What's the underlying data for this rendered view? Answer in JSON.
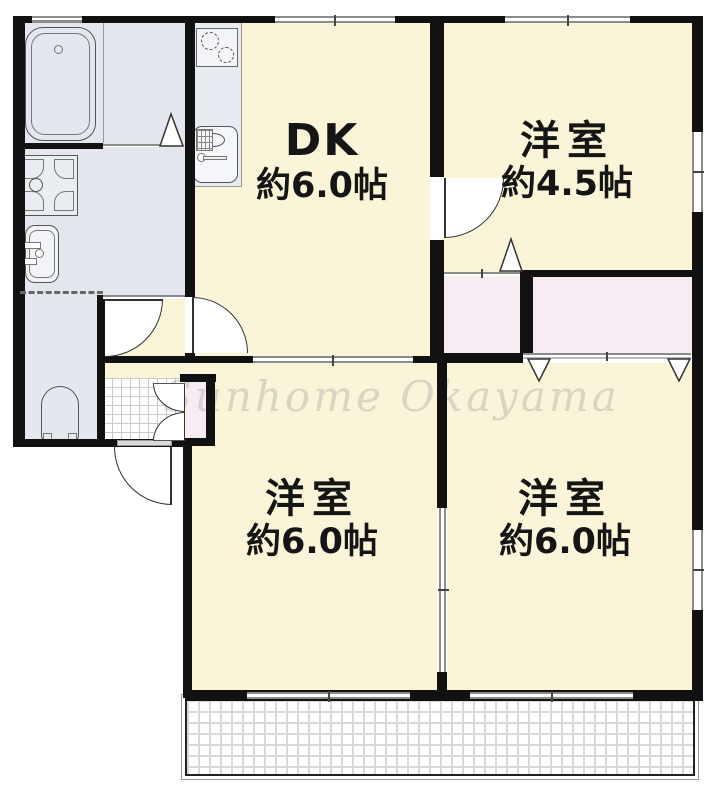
{
  "watermark": "Sunhome Okayama",
  "rooms": [
    {
      "name": "DK",
      "size": "約6.0帖"
    },
    {
      "name": "洋室",
      "size": "約4.5帖"
    },
    {
      "name": "洋室",
      "size": "約6.0帖"
    },
    {
      "name": "洋室",
      "size": "約6.0帖"
    }
  ],
  "fixtures": [
    "bathtub",
    "washing-machine-pan",
    "washbasin",
    "toilet",
    "gas-stove",
    "kitchen-sink",
    "genkan-tiles",
    "shoe-closet",
    "closet",
    "balcony"
  ],
  "colors": {
    "wall": "#111111",
    "room_floor": "#FAF5D8",
    "wet_area_floor": "#E4E7EE",
    "closet_floor": "#F7ECF4",
    "opening_line": "#8C8C8C",
    "watermark_text": "rgba(140,140,140,0.30)",
    "balcony_grid": "#D6D6D6",
    "tile_grid": "#C9C9C9",
    "fixture_line": "#555555"
  }
}
